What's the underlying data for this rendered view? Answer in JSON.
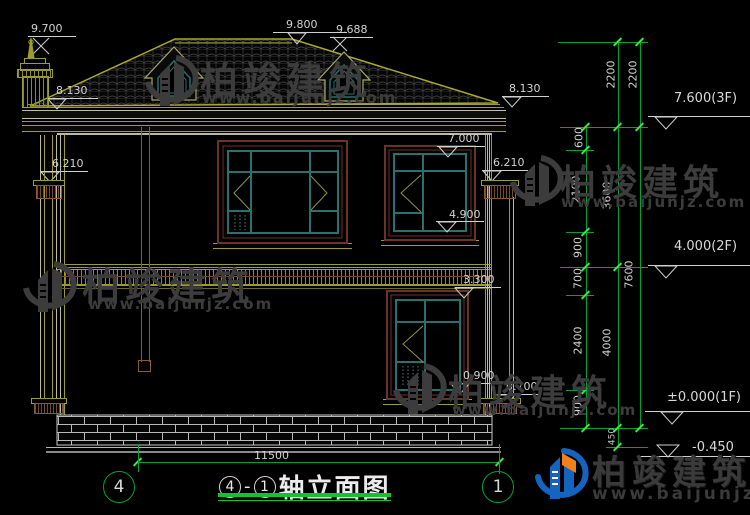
{
  "title": {
    "axis_from": "4",
    "dash": "-",
    "axis_to": "1",
    "name": "轴立面图"
  },
  "axes": {
    "left": "4",
    "right": "1"
  },
  "dims": {
    "overall": "11500",
    "inner": [
      "600",
      "2100",
      "900",
      "700",
      "2400",
      "900"
    ],
    "middle": [
      "2200",
      "3600",
      "4000",
      "450"
    ],
    "outer": [
      "2200",
      "7600"
    ]
  },
  "marks": {
    "chimney_top": "9.700",
    "ridge": "9.800",
    "ridge2": "9.688",
    "eave_left": "8.130",
    "eave_right": "8.130",
    "window_head_2f": "7.000",
    "capital_left": "6.210",
    "capital_right": "6.210",
    "sill_2f": "4.900",
    "floor_band": "3.300",
    "sill_1f": "0.900",
    "capital_1f": "0.700"
  },
  "levels": {
    "f3": "7.600(3F)",
    "f2": "4.000(2F)",
    "f1": "±0.000(1F)",
    "foundation": "-0.450"
  },
  "watermark": {
    "brand": "柏竣建筑",
    "url": "www.baijunjz.com"
  },
  "logo": {
    "brand": "柏竣建筑",
    "url": "www.baijunjz.com"
  },
  "colors": {
    "dim_green": "#00a13a",
    "tick_green": "#3fe83c",
    "text_gray": "#d2d2d2",
    "line_olive": "#9c9c2e",
    "frame_brown": "#6b3226",
    "window_teal": "#2a7070",
    "watermark_gray": "#3c3c3c",
    "logo_blue": "#1565c0",
    "logo_orange": "#f08019"
  }
}
